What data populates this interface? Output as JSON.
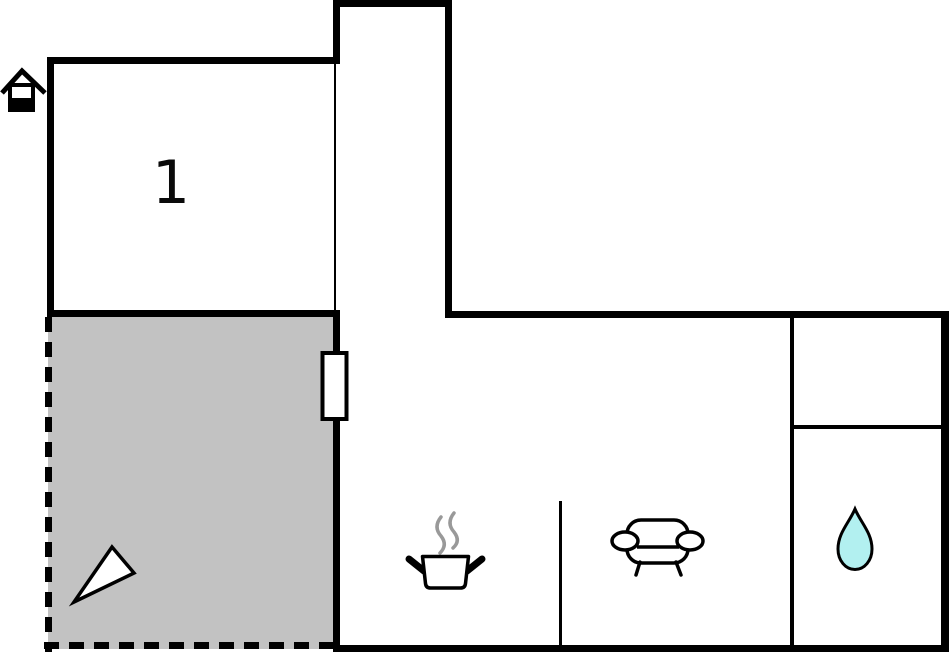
{
  "plan": {
    "room_label": "1",
    "colors": {
      "background": "#ffffff",
      "wall": "#000000",
      "terrace_fill": "#c2c2c2",
      "door_fill": "#ffffff",
      "icon_fill": "#ffffff",
      "steam": "#999999",
      "water_drop_fill": "#b2f0f0"
    },
    "icons": {
      "entrance": "house-icon",
      "terrace": "north-arrow-icon",
      "kitchen": "cooking-pot-icon",
      "living_room": "sofa-icon",
      "bathroom": "water-drop-icon",
      "door": "door-window-marker"
    }
  }
}
